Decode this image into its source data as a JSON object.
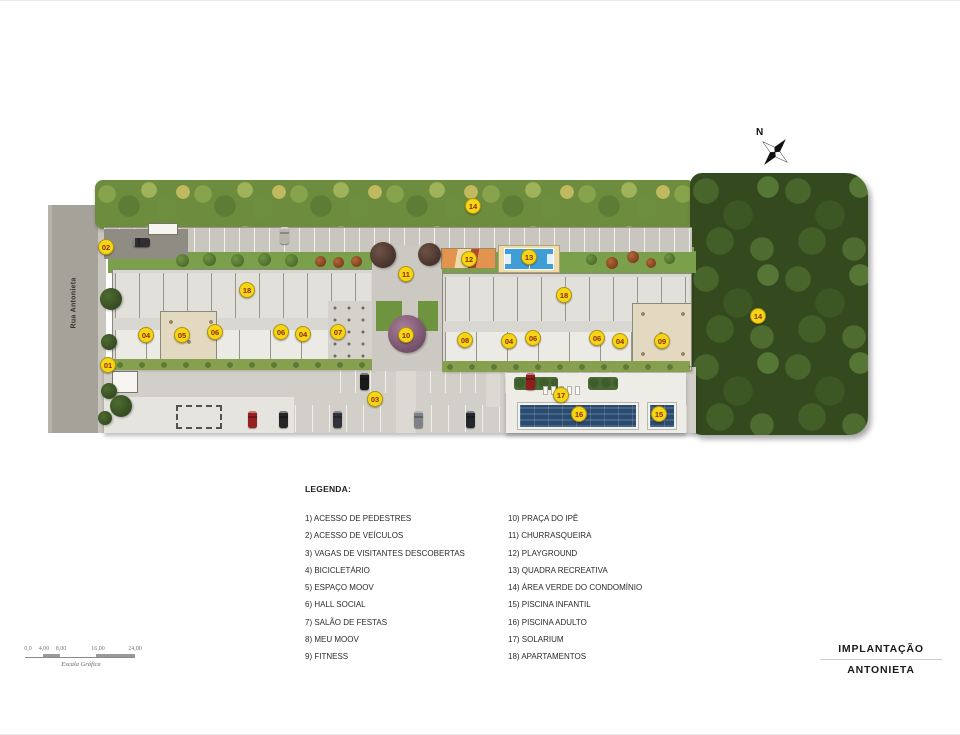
{
  "plan": {
    "street_label": "Rua Antonieta",
    "markers": [
      {
        "n": "02",
        "x": 106,
        "y": 246
      },
      {
        "n": "01",
        "x": 108,
        "y": 364
      },
      {
        "n": "04",
        "x": 146,
        "y": 334
      },
      {
        "n": "05",
        "x": 182,
        "y": 334
      },
      {
        "n": "06",
        "x": 215,
        "y": 331
      },
      {
        "n": "18",
        "x": 247,
        "y": 289
      },
      {
        "n": "06",
        "x": 281,
        "y": 331
      },
      {
        "n": "04",
        "x": 303,
        "y": 333
      },
      {
        "n": "07",
        "x": 338,
        "y": 331
      },
      {
        "n": "14",
        "x": 473,
        "y": 205
      },
      {
        "n": "11",
        "x": 406,
        "y": 273
      },
      {
        "n": "12",
        "x": 469,
        "y": 258
      },
      {
        "n": "13",
        "x": 529,
        "y": 256
      },
      {
        "n": "10",
        "x": 406,
        "y": 334
      },
      {
        "n": "08",
        "x": 465,
        "y": 339
      },
      {
        "n": "04",
        "x": 509,
        "y": 340
      },
      {
        "n": "06",
        "x": 533,
        "y": 337
      },
      {
        "n": "18",
        "x": 564,
        "y": 294
      },
      {
        "n": "06",
        "x": 597,
        "y": 337
      },
      {
        "n": "04",
        "x": 620,
        "y": 340
      },
      {
        "n": "09",
        "x": 662,
        "y": 340
      },
      {
        "n": "14",
        "x": 758,
        "y": 315
      },
      {
        "n": "03",
        "x": 375,
        "y": 398
      },
      {
        "n": "17",
        "x": 561,
        "y": 394
      },
      {
        "n": "16",
        "x": 579,
        "y": 413
      },
      {
        "n": "15",
        "x": 659,
        "y": 413
      }
    ]
  },
  "compass": {
    "label": "N"
  },
  "scale_bar": {
    "ticks": [
      "0,0",
      "4,00",
      "8,00",
      "16,00",
      "24,00"
    ],
    "caption": "Escala Gráfica"
  },
  "legend": {
    "heading": "LEGENDA:",
    "columns": [
      {
        "items": [
          "1) ACESSO DE PEDESTRES",
          "2) ACESSO DE VEÍCULOS",
          "3) VAGAS DE VISITANTES DESCOBERTAS",
          "4) BICICLETÁRIO",
          "5) ESPAÇO MOOV",
          "6) HALL SOCIAL",
          "7) SALÃO DE FESTAS",
          "8) MEU MOOV",
          "9) FITNESS"
        ]
      },
      {
        "items": [
          "10) PRAÇA DO IPÊ",
          "11) CHURRASQUEIRA",
          "12) PLAYGROUND",
          "13) QUADRA RECREATIVA",
          "14) ÁREA VERDE DO CONDOMÍNIO",
          "15) PISCINA INFANTIL",
          "16) PISCINA ADULTO",
          "17) SOLARIUM",
          "18) APARTAMENTOS"
        ]
      }
    ]
  },
  "title_block": {
    "line1": "IMPLANTAÇÃO",
    "line2": "ANTONIETA"
  },
  "colors": {
    "marker_bg": "#f5d515",
    "marker_text": "#8a2c06",
    "pool_blue": "#2c4a6d",
    "lawn_green": "#7aa04c",
    "forest_green": "#35491f",
    "court_blue": "#3f9ed6"
  }
}
